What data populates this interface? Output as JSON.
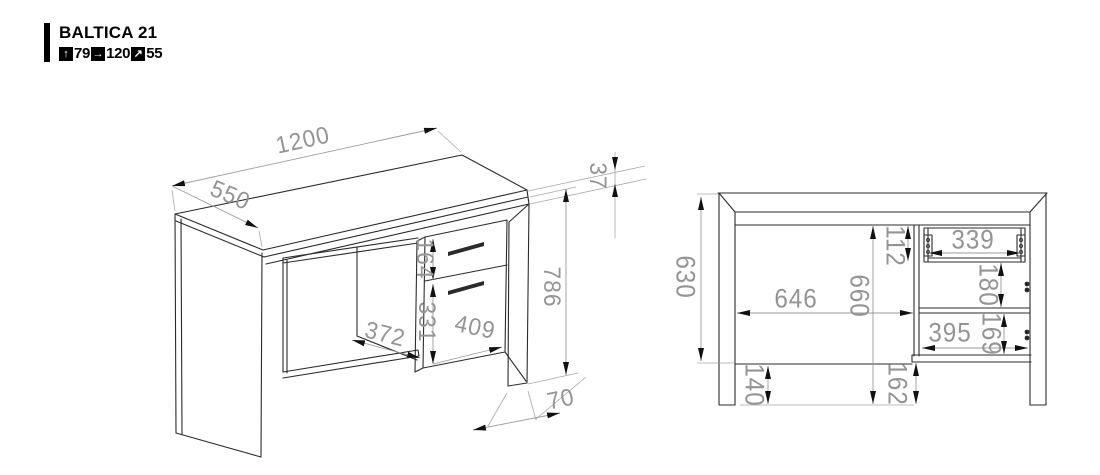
{
  "header": {
    "title": "BALTICA 21",
    "spec": [
      {
        "label": "height",
        "icon": "arrow-up-icon",
        "glyph": "↑",
        "value": "79"
      },
      {
        "label": "width",
        "icon": "arrow-right-icon",
        "glyph": "→",
        "value": "120"
      },
      {
        "label": "depth",
        "icon": "arrow-diagonal-icon",
        "glyph": "↗",
        "value": "55"
      }
    ]
  },
  "isometric_view": {
    "dimensions": {
      "width": "1200",
      "depth": "550",
      "top_thickness": "37",
      "total_height": "786",
      "drawer_front_height": "164",
      "door_front_height": "331",
      "leg_opening_width": "372",
      "pedestal_width": "409",
      "foot_height": "70"
    }
  },
  "front_view": {
    "dimensions": {
      "side_panel_height": "630",
      "opening_width": "646",
      "opening_height": "660",
      "drawer_niche_height": "112",
      "drawer_niche_width": "339",
      "middle_niche_height": "180",
      "lower_niche_width": "395",
      "lower_niche_height": "169",
      "bottom_rail_height": "140",
      "pedestal_ground_clearance": "162"
    }
  },
  "colors": {
    "outline": "#2b2b2b",
    "dimension_text": "#949494",
    "accent": "#000000",
    "background": "#ffffff"
  }
}
